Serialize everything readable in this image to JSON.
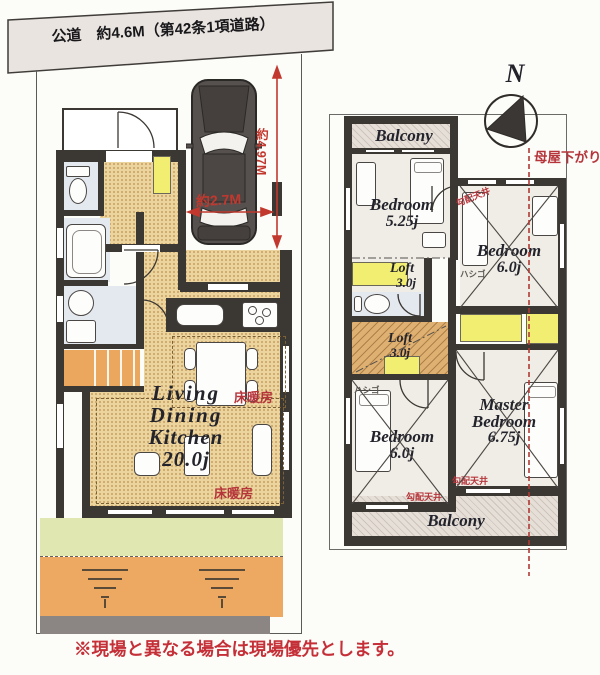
{
  "road": {
    "label": "公道　約4.6M（第42条1項道路）"
  },
  "compass": {
    "north": "N"
  },
  "dimensions": {
    "width": "約2.7M",
    "depth": "約4.97M"
  },
  "notes": {
    "moya_sagari": "母屋下がり",
    "disclaimer": "※現場と異なる場合は現場優先とします。"
  },
  "floor1": {
    "ldk": {
      "l1": "Living",
      "l2": "Dining",
      "l3": "Kitchen",
      "size": "20.0j"
    },
    "floor_heating": "床暖房"
  },
  "floor2": {
    "balcony": "Balcony",
    "bedroom_small": {
      "name": "Bedroom",
      "size": "5.25j"
    },
    "bedroom_ne": {
      "name": "Bedroom",
      "size": "6.0j"
    },
    "bedroom_sw": {
      "name": "Bedroom",
      "size": "6.0j"
    },
    "master": {
      "l1": "Master",
      "l2": "Bedroom",
      "size": "6.75j"
    },
    "loft_upper": {
      "name": "Loft",
      "size": "3.0j"
    },
    "loft_lower": {
      "name": "Loft",
      "size": "3.0j"
    },
    "sloped_ceiling": "勾配天井",
    "ladder": "ハシゴ"
  },
  "colors": {
    "accent_red": "#b5353b",
    "wall": "#3b3733",
    "floor_tan": "#ecd49e",
    "closet_yellow": "#f1ee72",
    "garden_green": "#e0e7b0",
    "soil_orange": "#eda961"
  }
}
